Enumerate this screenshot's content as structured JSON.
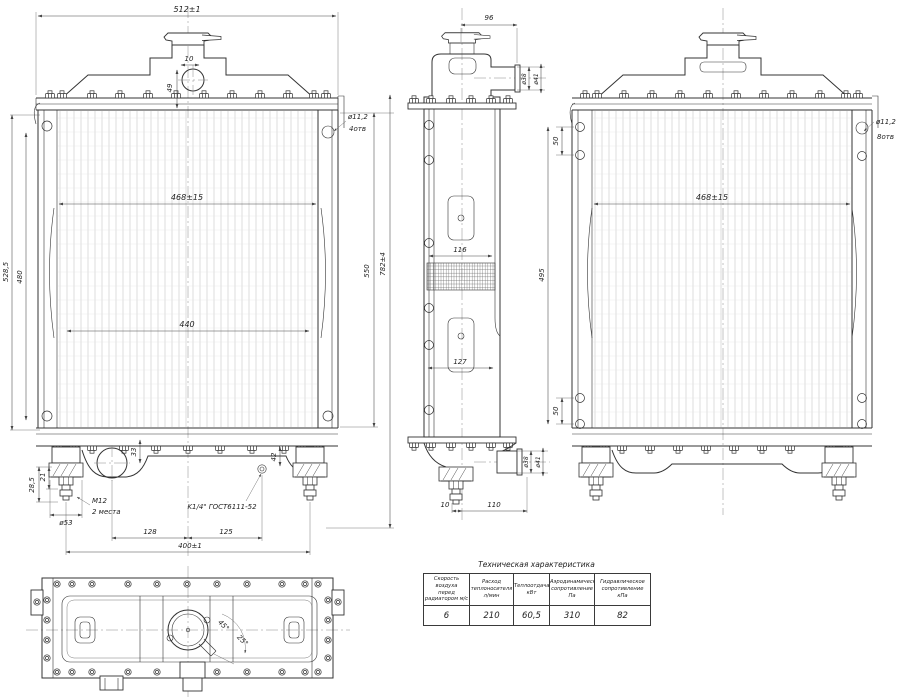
{
  "drawing": {
    "front_view": {
      "dims": {
        "width_top": "512±1",
        "neck_offset": "10",
        "neck_height": "49",
        "core_width": "468±15",
        "core_width_inner": "440",
        "height_outer_left": "528,5",
        "height_inner_left": "480",
        "height_right": "550",
        "height_overall": "782±4",
        "mount_height_a": "28,5",
        "mount_height_b": "21",
        "mount_dia": "ø53",
        "drain_offset_v": "33",
        "tap_offset_v": "42",
        "span_left": "128",
        "span_right": "125",
        "span_mounts": "400±1"
      },
      "notes": {
        "holes_dia": "ø11,2",
        "holes_count": "4отв",
        "thread": "M12",
        "thread_places": "2 места",
        "tap_thread": "K1/4\" ГОСТ6111-52"
      }
    },
    "side_view": {
      "dims": {
        "top_width": "96",
        "pipe_top_inner": "ø38",
        "pipe_top_outer": "ø41",
        "core_depth_top": "116",
        "core_depth_bottom": "127",
        "pipe_bottom_inner": "ø38",
        "pipe_bottom_outer": "ø41",
        "stud_offset": "10",
        "pipe_offset": "110"
      }
    },
    "rear_view": {
      "dims": {
        "hole_pitch_top": "50",
        "hole_span": "495",
        "hole_pitch_bottom": "50",
        "core_width": "468±15"
      },
      "notes": {
        "holes_dia": "ø11,2",
        "holes_count": "8отв"
      }
    },
    "top_view": {
      "dims": {
        "angle_a": "45°",
        "angle_b": "25°"
      }
    },
    "table": {
      "title": "Техническая характеристика",
      "columns": [
        {
          "h1": "Скорость воздуха",
          "h2": "перед",
          "h3": "радиатором м/с",
          "value": "6"
        },
        {
          "h1": "Расход",
          "h2": "теплоносителя",
          "h3": "л/мин",
          "value": "210"
        },
        {
          "h1": "Теплоотдача",
          "h2": "кВт",
          "h3": "",
          "value": "60,5"
        },
        {
          "h1": "Аэродинамическое",
          "h2": "сопротивление",
          "h3": "Па",
          "value": "310"
        },
        {
          "h1": "Гидравлическое",
          "h2": "сопротивление",
          "h3": "кПа",
          "value": "82"
        }
      ]
    }
  }
}
